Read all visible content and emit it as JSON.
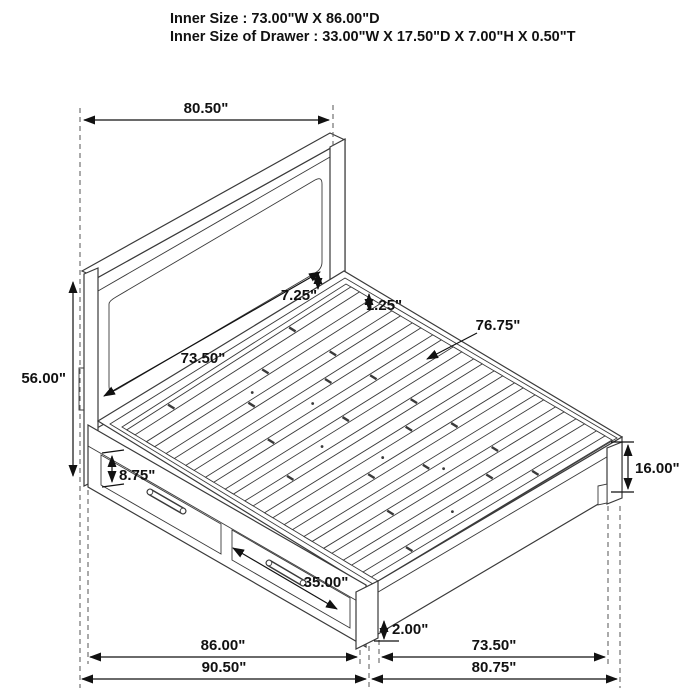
{
  "title": {
    "line1": "Inner Size : 73.00\"W X 86.00\"D",
    "line2": "Inner Size of Drawer : 33.00\"W X 17.50\"D X 7.00\"H X 0.50\"T"
  },
  "dimensions": {
    "headboard_width": "80.50\"",
    "headboard_inner_width": "73.50\"",
    "headboard_height": "56.00\"",
    "panel_to_rail_gap": "7.25\"",
    "slat_thickness": "1.25\"",
    "slat_length": "76.75\"",
    "drawer_front_height": "8.75\"",
    "drawer_front_width": "35.00\"",
    "ground_clearance": "2.00\"",
    "footboard_height": "16.00\"",
    "side_rail_inner_depth": "86.00\"",
    "overall_depth": "90.50\"",
    "footboard_inner_width": "73.50\"",
    "footboard_overall_width": "80.75\""
  },
  "drawing": {
    "subject": "storage bed frame with two side drawers",
    "line_color": "#3a3a3a",
    "text_color": "#111111",
    "background": "#ffffff"
  }
}
